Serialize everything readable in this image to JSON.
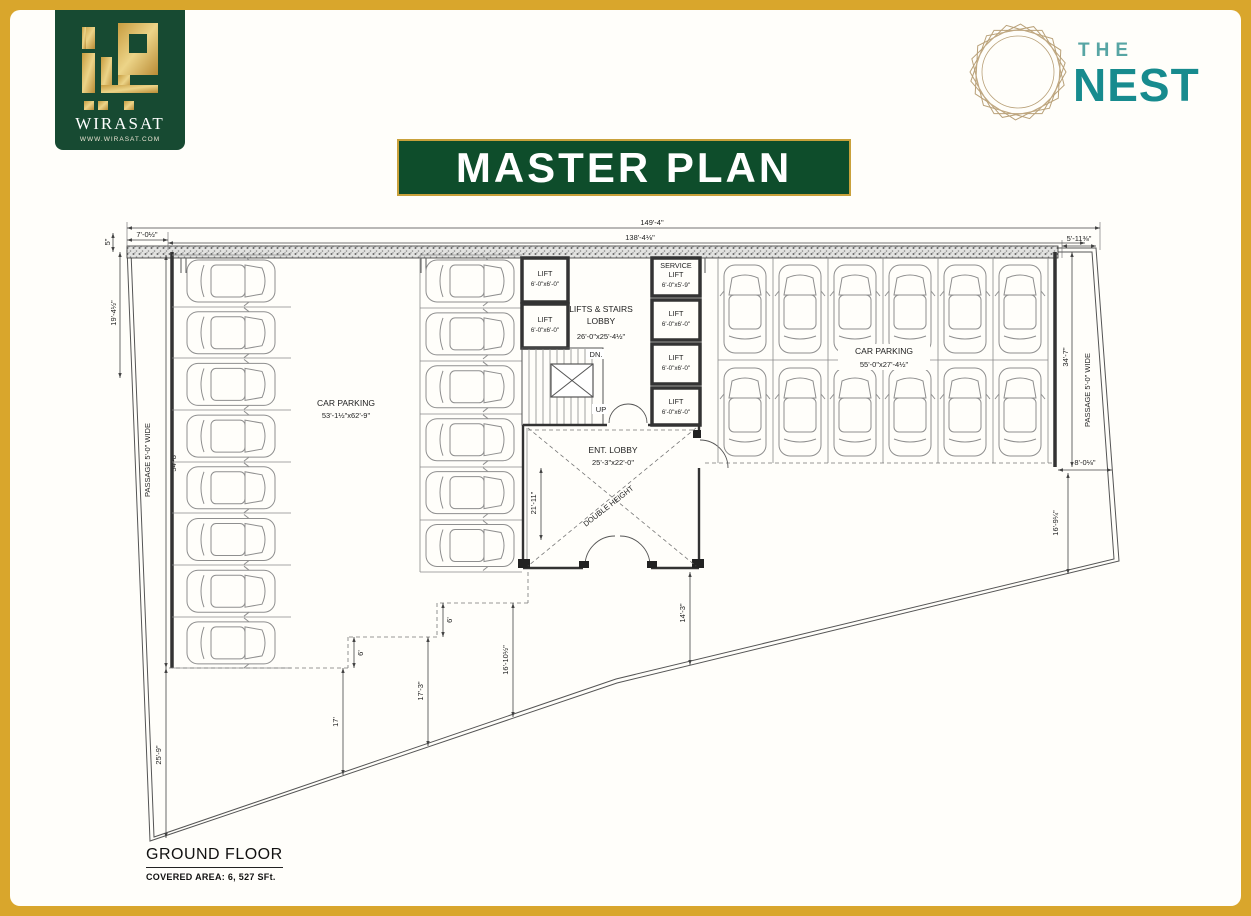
{
  "header": {
    "wirasat": {
      "name": "WIRASAT",
      "website": "WWW.WIRASAT.COM"
    },
    "nest": {
      "the": "THE",
      "nest": "NEST"
    },
    "banner": "MASTER PLAN"
  },
  "footer": {
    "floor": "GROUND FLOOR",
    "covered_area": "COVERED AREA: 6, 527 SFt."
  },
  "plan": {
    "labels": {
      "car_parking_left": "CAR PARKING",
      "car_parking_left_size": "53'-1½\"x62'-9\"",
      "car_parking_right": "CAR PARKING",
      "car_parking_right_size": "55'-0\"x27'-4½\"",
      "lifts_stairs_1": "LIFTS & STAIRS",
      "lifts_stairs_2": "LOBBY",
      "lifts_stairs_size": "26'-0\"x25'-4½\"",
      "lift": "LIFT",
      "lift_size": "6'-0\"x6'-0\"",
      "service_1": "SERVICE",
      "service_2": "LIFT",
      "service_size": "6'-0\"x5'-9\"",
      "ent_lobby": "ENT. LOBBY",
      "ent_lobby_size": "25'-3\"x22'-0\"",
      "double_height": "DOUBLE HEIGHT",
      "dn": "DN.",
      "up": "UP",
      "passage_left": "PASSAGE 5'-0\" WIDE",
      "passage_right": "PASSAGE 5'-0\" WIDE"
    },
    "dims": {
      "d149": "149'-4\"",
      "d138": "138'-4⅛\"",
      "d7": "7'-0½\"",
      "d5_11": "5'-11⅜\"",
      "d5": "5\"",
      "d19": "19'-4½\"",
      "d54": "54'-8\"",
      "d25": "25'-9\"",
      "d21": "21'-11\"",
      "d6a": "6'",
      "d6b": "6'",
      "d17": "17'",
      "d17_3": "17'-3\"",
      "d16_10": "16'-10½\"",
      "d14_3": "14'-3\"",
      "d34_7": "34'-7\"",
      "d8_0": "8'-0⅛\"",
      "d16_9": "16'-9¼\""
    },
    "parking": {
      "left_count": 8,
      "middle_count": 6,
      "right_cols": 6
    }
  }
}
